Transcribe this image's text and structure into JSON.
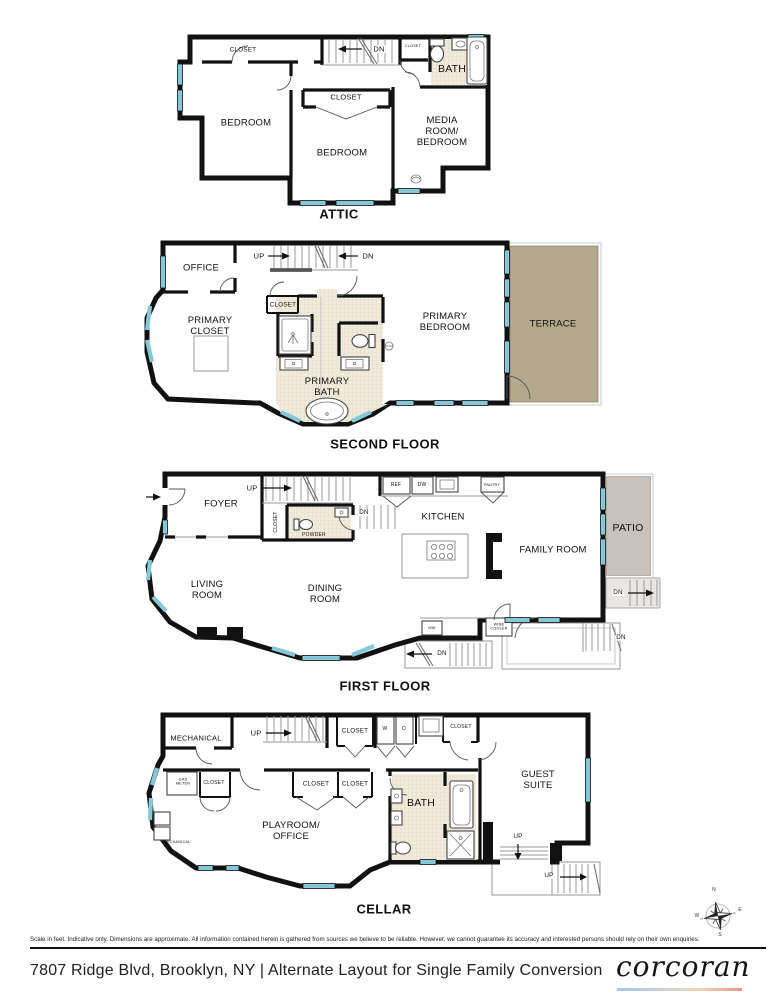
{
  "colors": {
    "wall": "#111111",
    "window": "#85c9d9",
    "terrace_fill": "#b4a88d",
    "patio_fill": "#c9c1bd",
    "bath_tile": "#f1ebdc",
    "brand_gradient_left": "#a9c4e4",
    "brand_gradient_right": "#f0958a"
  },
  "floors": {
    "attic": {
      "title": "ATTIC",
      "labels": {
        "closet_tl": "CLOSET",
        "dn": "DN",
        "closet_hall": "CLOSET",
        "bath": "BATH",
        "bedroom_left": "BEDROOM",
        "closet_mid": "CLOSET",
        "bedroom_mid": "BEDROOM",
        "media": "MEDIA\nROOM/\nBEDROOM"
      }
    },
    "second": {
      "title": "SECOND FLOOR",
      "labels": {
        "office": "OFFICE",
        "up": "UP",
        "dn": "DN",
        "closet": "CLOSET",
        "primary_closet": "PRIMARY\nCLOSET",
        "primary_bath": "PRIMARY\nBATH",
        "primary_bedroom": "PRIMARY\nBEDROOM",
        "terrace": "TERRACE"
      }
    },
    "first": {
      "title": "FIRST FLOOR",
      "labels": {
        "foyer": "FOYER",
        "up": "UP",
        "dn_to_cellar": "DN",
        "closet": "CLOSET",
        "powder": "POWDER",
        "ref": "REF",
        "dw": "DW",
        "pantry": "PANTRY",
        "kitchen": "KITCHEN",
        "living": "LIVING\nROOM",
        "dining": "DINING\nROOM",
        "family": "FAMILY ROOM",
        "patio": "PATIO",
        "dn_patio": "DN",
        "mw": "MW",
        "wine": "WINE\nCOOLER",
        "dn_stairwell": "DN",
        "dn_deck": "DN"
      }
    },
    "cellar": {
      "title": "CELLAR",
      "labels": {
        "mechanical": "MECHANICAL",
        "up_stairs": "UP",
        "closet_hall": "CLOSET",
        "w": "W",
        "d": "D",
        "closet_tr": "CLOSET",
        "gas_meter": "GAS\nMETER",
        "closet_left": "CLOSET",
        "closet_c1": "CLOSET",
        "closet_c2": "CLOSET",
        "bath": "BATH",
        "mechanical_small": "MECHANICAL",
        "playroom": "PLAYROOM/\nOFFICE",
        "guest_suite": "GUEST\nSUITE",
        "up_inner": "UP",
        "up_outer": "UP"
      }
    }
  },
  "compass": {
    "n": "N",
    "e": "E",
    "s": "S",
    "w": "W"
  },
  "footer": {
    "disclaimer": "Scale in feet. Indicative only. Dimensions are approximate. All information contained herein is gathered from sources we believe to be reliable. However, we cannot guarantee its accuracy and interested persons should rely on their own enquiries.",
    "address_line": "7807 Ridge Blvd, Brooklyn, NY | Alternate Layout for Single Family Conversion",
    "brand": "corcoran"
  }
}
